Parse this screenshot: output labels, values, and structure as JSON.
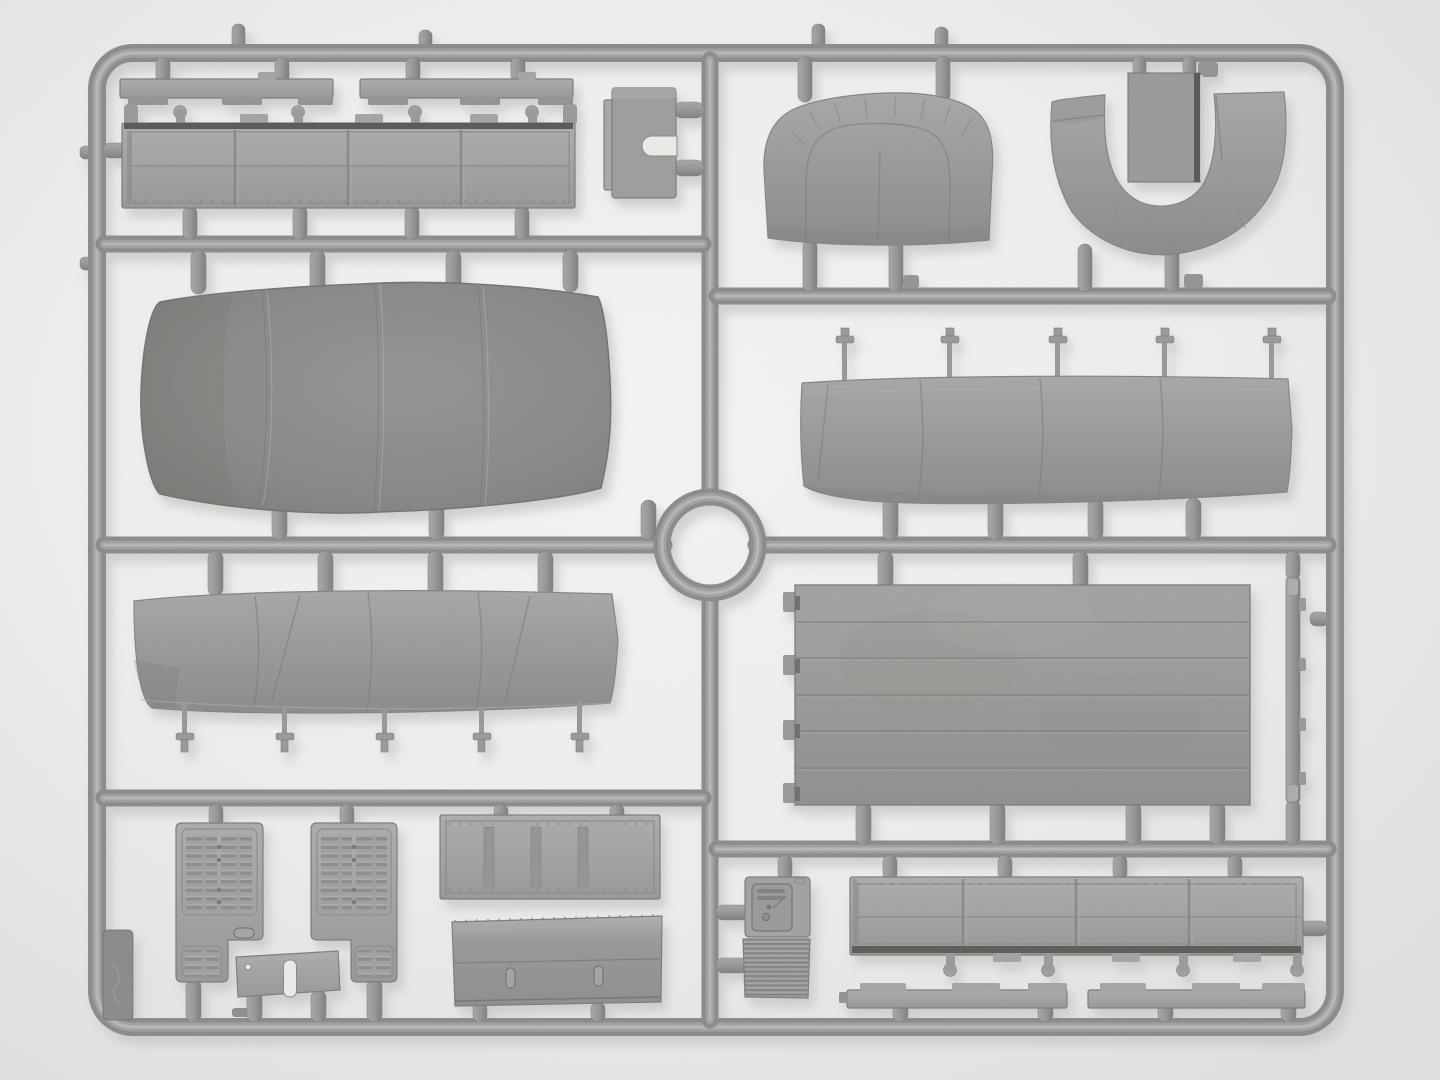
{
  "scene": {
    "description": "Photograph of a gray injection-molded plastic model kit sprue (parts frame) lying on a white lightbox background, photographed from above",
    "object": "model-kit-sprue",
    "material": "gray styrene plastic",
    "background": "white seamless, slightly vignetted",
    "text_visible": "none"
  },
  "colors": {
    "background_center": "#f5f4f2",
    "background_mid": "#eeedeb",
    "background_edge": "#e0dfdd",
    "runner_light": "#b7b6b4",
    "runner_mid": "#a1a09e",
    "runner_dark": "#8c8b89",
    "stud_light": "#a8a7a5",
    "stud_mid": "#989796",
    "stud_dark": "#7f7e7d",
    "panel_light": "#aeacaa",
    "panel_dark": "#9a9896",
    "panel_big_light": "#a5a3a1",
    "panel_big_dark": "#918f8d",
    "canvas_light": "#a9a7a5",
    "canvas_mid": "#9b9997",
    "canvas_dark": "#8d8b89",
    "tarp_center": "#969492",
    "tarp_mid": "#8a8886",
    "tarp_edge": "#7d7b79",
    "toolbox_light": "#b0afad",
    "toolbox_dark": "#8f8e8c",
    "gap_shadow": "#4c4b4a",
    "slot_light": "#eceae7",
    "tag_color": "#8b8a8c",
    "shadow": "#c9c8c5"
  },
  "sprue": {
    "frame": {
      "shape": "rounded rectangle",
      "corner_radius_px": 36,
      "bar_thickness_px": 18
    },
    "hub_ring": {
      "shape": "circular ring",
      "cx": 710,
      "cy": 545,
      "outer_radius_px": 56
    },
    "runners": "central vertical spine through ring hub plus six horizontal cross-bars dividing the frame into eight bays",
    "parts": [
      {
        "id": "rail-strip-a",
        "name": "stepped rail strip",
        "location": "top-left, upper"
      },
      {
        "id": "rail-strip-b",
        "name": "stepped rail strip",
        "location": "top-left, upper"
      },
      {
        "id": "bed-side-panel-top",
        "name": "long riveted cargo-bed side panel, 4 bays",
        "location": "top-left"
      },
      {
        "id": "slotted-bracket",
        "name": "small bracket with open slot",
        "location": "top-center, left of spine"
      },
      {
        "id": "cab-canvas-arch",
        "name": "arched cab canvas cover with stitched seam and wrinkles",
        "location": "top-right, left"
      },
      {
        "id": "backing-plate",
        "name": "flat rectangular plate",
        "location": "top-right, inside U piece"
      },
      {
        "id": "canvas-u-cover",
        "name": "U-shaped canvas cover",
        "location": "top-right, right"
      },
      {
        "id": "canvas-curtain-right",
        "name": "canvas side curtain with 5 fastening T-pins pointing up",
        "location": "right, middle band",
        "pin_count": 5
      },
      {
        "id": "canvas-tilt-barrel",
        "name": "large barrel-shaped canvas tilt section, 3 fold seams",
        "location": "left, middle band"
      },
      {
        "id": "canvas-curtain-left",
        "name": "canvas side curtain with 5 fastening T-pins pointing down",
        "location": "left, lower-middle band",
        "pin_count": 5
      },
      {
        "id": "bed-floor-panel",
        "name": "large planked panel, 6 planks, hinge tabs on left edge",
        "location": "right, lower-middle band",
        "plank_count": 6
      },
      {
        "id": "batten-strip",
        "name": "narrow batten strip with side tabs",
        "location": "right of planked panel"
      },
      {
        "id": "louver-panel-left",
        "name": "L-shaped louvered hood panel, 2 louver columns + leg column",
        "location": "bottom-left"
      },
      {
        "id": "louver-panel-right",
        "name": "mirrored L-shaped louvered hood panel",
        "location": "bottom-left"
      },
      {
        "id": "notched-plate",
        "name": "small plate with keyhole notch and round hole",
        "location": "bottom-left, between louver panels"
      },
      {
        "id": "slatted-tail-panel",
        "name": "bordered panel with 3 vertical slats",
        "location": "bottom-left, right side"
      },
      {
        "id": "toolbox-panel",
        "name": "toolbox lid panel with 2 latch pulls",
        "location": "bottom-left, right side, lower"
      },
      {
        "id": "molding-tag",
        "name": "small embossed molding tag",
        "location": "inner left frame edge, bottom"
      },
      {
        "id": "door-inner-panel",
        "name": "small door/instrument panel with recessed face, slots and holes",
        "location": "bottom-right, left of spine"
      },
      {
        "id": "radiator-core",
        "name": "corrugated radiator core block",
        "location": "below door panel"
      },
      {
        "id": "bed-side-panel-bottom",
        "name": "long riveted cargo-bed side panel, 4 bays",
        "location": "bottom-right"
      },
      {
        "id": "rail-strip-c",
        "name": "stepped rail strip",
        "location": "bottom-right, lower"
      },
      {
        "id": "rail-strip-d",
        "name": "stepped rail strip",
        "location": "bottom-right, lower"
      }
    ],
    "gates": "teardrop-shaped sprue gates connect every part to the runner bars"
  }
}
